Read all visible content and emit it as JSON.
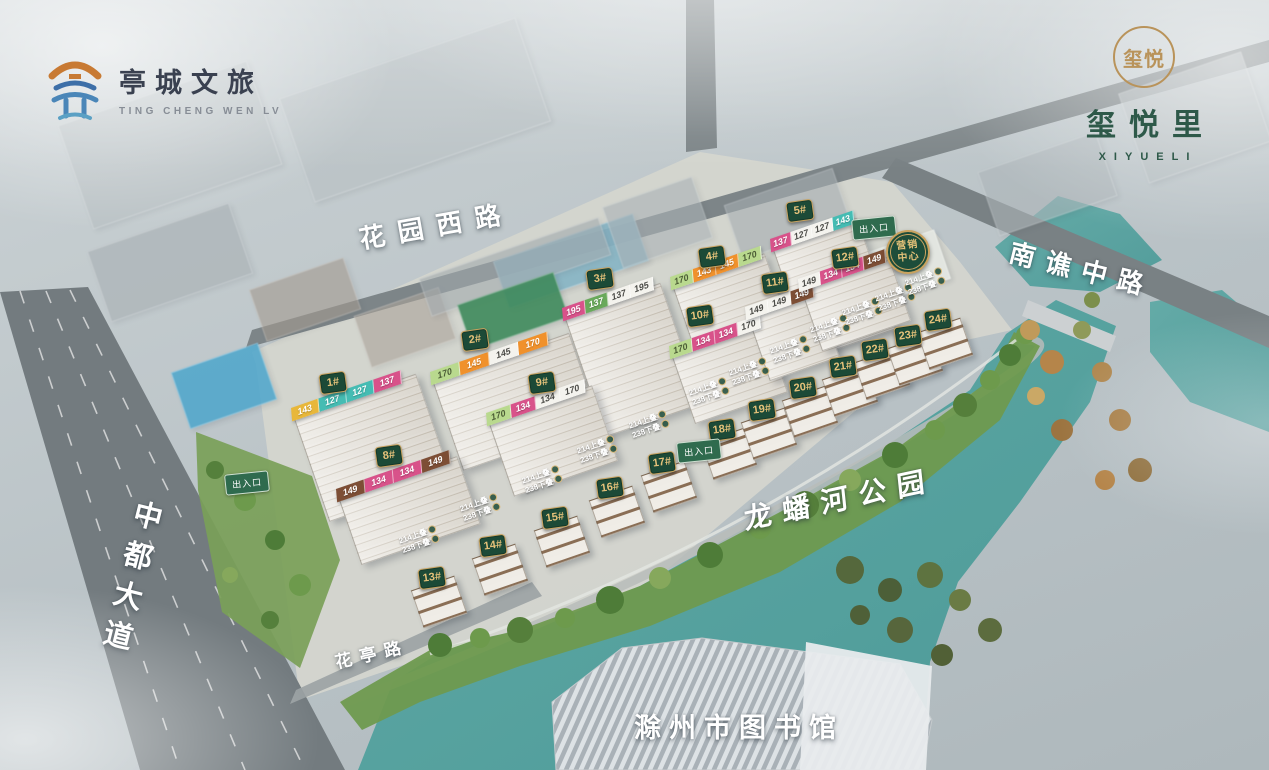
{
  "brand_left": {
    "icon": "pavilion-logo-icon",
    "name": "亭城文旅",
    "sub": "TING CHENG WEN LV"
  },
  "brand_right": {
    "icon": "xiyue-seal-icon",
    "seal": "玺悦",
    "name": "玺悦里",
    "sub": "XIYUELI"
  },
  "road_labels": {
    "huayuan_west_road": "花园西路",
    "nanqiao_middle_road": "南谯中路",
    "zhongdu_avenue": "中都大道",
    "huating_road": "花亭路"
  },
  "area_labels": {
    "longpan_river_park": "龙蟠河公园",
    "chuzhou_library": "滁州市图书馆"
  },
  "marketing_center": {
    "line1": "营销",
    "line2": "中心",
    "x": 908,
    "y": 252
  },
  "entrance_label": "出入口",
  "entrances": [
    {
      "x": 247,
      "y": 483
    },
    {
      "x": 874,
      "y": 228
    },
    {
      "x": 699,
      "y": 451
    }
  ],
  "villa_unit_tag": {
    "line1": "214上叠",
    "line2": "238下叠"
  },
  "buildings": [
    {
      "label": "1#",
      "x": 333,
      "y": 385,
      "bw": 130,
      "bh": 112,
      "strips": {
        "x": 291,
        "y": 408,
        "cw": 29,
        "cells": [
          {
            "v": "143",
            "c": "yellow"
          },
          {
            "v": "127",
            "c": "teal"
          },
          {
            "v": "127",
            "c": "teal"
          },
          {
            "v": "137",
            "c": "pink"
          }
        ]
      }
    },
    {
      "label": "2#",
      "x": 475,
      "y": 342,
      "bw": 145,
      "bh": 96,
      "strips": {
        "x": 430,
        "y": 372,
        "cw": 31,
        "cells": [
          {
            "v": "170",
            "c": "lgreen"
          },
          {
            "v": "145",
            "c": "orange"
          },
          {
            "v": "145",
            "c": "white"
          },
          {
            "v": "170",
            "c": "orange"
          }
        ]
      }
    },
    {
      "label": "3#",
      "x": 600,
      "y": 281,
      "bw": 102,
      "bh": 128,
      "strips": {
        "x": 562,
        "y": 308,
        "cw": 24,
        "cells": [
          {
            "v": "195",
            "c": "pink"
          },
          {
            "v": "137",
            "c": "green"
          },
          {
            "v": "137",
            "c": "white"
          },
          {
            "v": "195",
            "c": "white"
          }
        ]
      }
    },
    {
      "label": "4#",
      "x": 712,
      "y": 259,
      "bw": 98,
      "bh": 92,
      "strips": {
        "x": 670,
        "y": 277,
        "cw": 24,
        "cells": [
          {
            "v": "170",
            "c": "lgreen"
          },
          {
            "v": "143",
            "c": "orange"
          },
          {
            "v": "145",
            "c": "orange"
          },
          {
            "v": "170",
            "c": "lgreen"
          }
        ]
      }
    },
    {
      "label": "5#",
      "x": 800,
      "y": 213,
      "bw": 90,
      "bh": 118,
      "strips": {
        "x": 770,
        "y": 239,
        "cw": 22,
        "cells": [
          {
            "v": "137",
            "c": "pink"
          },
          {
            "v": "127",
            "c": "white"
          },
          {
            "v": "127",
            "c": "white"
          },
          {
            "v": "143",
            "c": "teal"
          }
        ]
      }
    },
    {
      "label": "8#",
      "x": 389,
      "y": 458,
      "bw": 126,
      "bh": 72,
      "strips": {
        "x": 336,
        "y": 489,
        "cw": 30,
        "cells": [
          {
            "v": "149",
            "c": "brown"
          },
          {
            "v": "134",
            "c": "pink"
          },
          {
            "v": "134",
            "c": "pink"
          },
          {
            "v": "149",
            "c": "brown"
          }
        ]
      }
    },
    {
      "label": "9#",
      "x": 542,
      "y": 385,
      "bw": 110,
      "bh": 80,
      "strips": {
        "x": 486,
        "y": 413,
        "cw": 26,
        "cells": [
          {
            "v": "170",
            "c": "lgreen"
          },
          {
            "v": "134",
            "c": "pink"
          },
          {
            "v": "134",
            "c": "white"
          },
          {
            "v": "170",
            "c": "white"
          }
        ]
      }
    },
    {
      "label": "10#",
      "x": 700,
      "y": 318,
      "bw": 98,
      "bh": 74,
      "strips": {
        "x": 669,
        "y": 346,
        "cw": 24,
        "cells": [
          {
            "v": "170",
            "c": "lgreen"
          },
          {
            "v": "134",
            "c": "pink"
          },
          {
            "v": "134",
            "c": "pink"
          },
          {
            "v": "170",
            "c": "white"
          }
        ]
      }
    },
    {
      "label": "11#",
      "x": 775,
      "y": 285,
      "bw": 74,
      "bh": 70,
      "strips": {
        "x": 745,
        "y": 307,
        "cw": 24,
        "cells": [
          {
            "v": "149",
            "c": "white"
          },
          {
            "v": "149",
            "c": "white"
          },
          {
            "v": "149",
            "c": "brown"
          }
        ]
      }
    },
    {
      "label": "12#",
      "x": 845,
      "y": 260,
      "bw": 94,
      "bh": 68,
      "strips": {
        "x": 798,
        "y": 279,
        "cw": 23,
        "cells": [
          {
            "v": "149",
            "c": "white"
          },
          {
            "v": "134",
            "c": "pink"
          },
          {
            "v": "134",
            "c": "pink"
          },
          {
            "v": "149",
            "c": "brown"
          }
        ]
      }
    }
  ],
  "villas": [
    {
      "label": "13#",
      "x": 432,
      "y": 580
    },
    {
      "label": "14#",
      "x": 493,
      "y": 548
    },
    {
      "label": "15#",
      "x": 555,
      "y": 520
    },
    {
      "label": "16#",
      "x": 610,
      "y": 490
    },
    {
      "label": "17#",
      "x": 662,
      "y": 465
    },
    {
      "label": "18#",
      "x": 722,
      "y": 432
    },
    {
      "label": "19#",
      "x": 762,
      "y": 412
    },
    {
      "label": "20#",
      "x": 803,
      "y": 390
    },
    {
      "label": "21#",
      "x": 843,
      "y": 369
    },
    {
      "label": "22#",
      "x": 875,
      "y": 352
    },
    {
      "label": "23#",
      "x": 908,
      "y": 338
    },
    {
      "label": "24#",
      "x": 938,
      "y": 322
    }
  ],
  "colors": {
    "water": "#57a3a0",
    "flag_green": "#1c4a37",
    "flag_gold": "#c9a35f",
    "brand_green": "#2e5949",
    "brand_gold": "#b9935a",
    "strip_yellow": "#e8b73a",
    "strip_teal": "#45bcb3",
    "strip_pink": "#d8528a",
    "strip_orange": "#f0912c",
    "strip_lightgreen": "#b9d98e",
    "strip_green": "#69a95b",
    "strip_brown": "#7d4e35",
    "strip_white": "#f4f3ee"
  }
}
